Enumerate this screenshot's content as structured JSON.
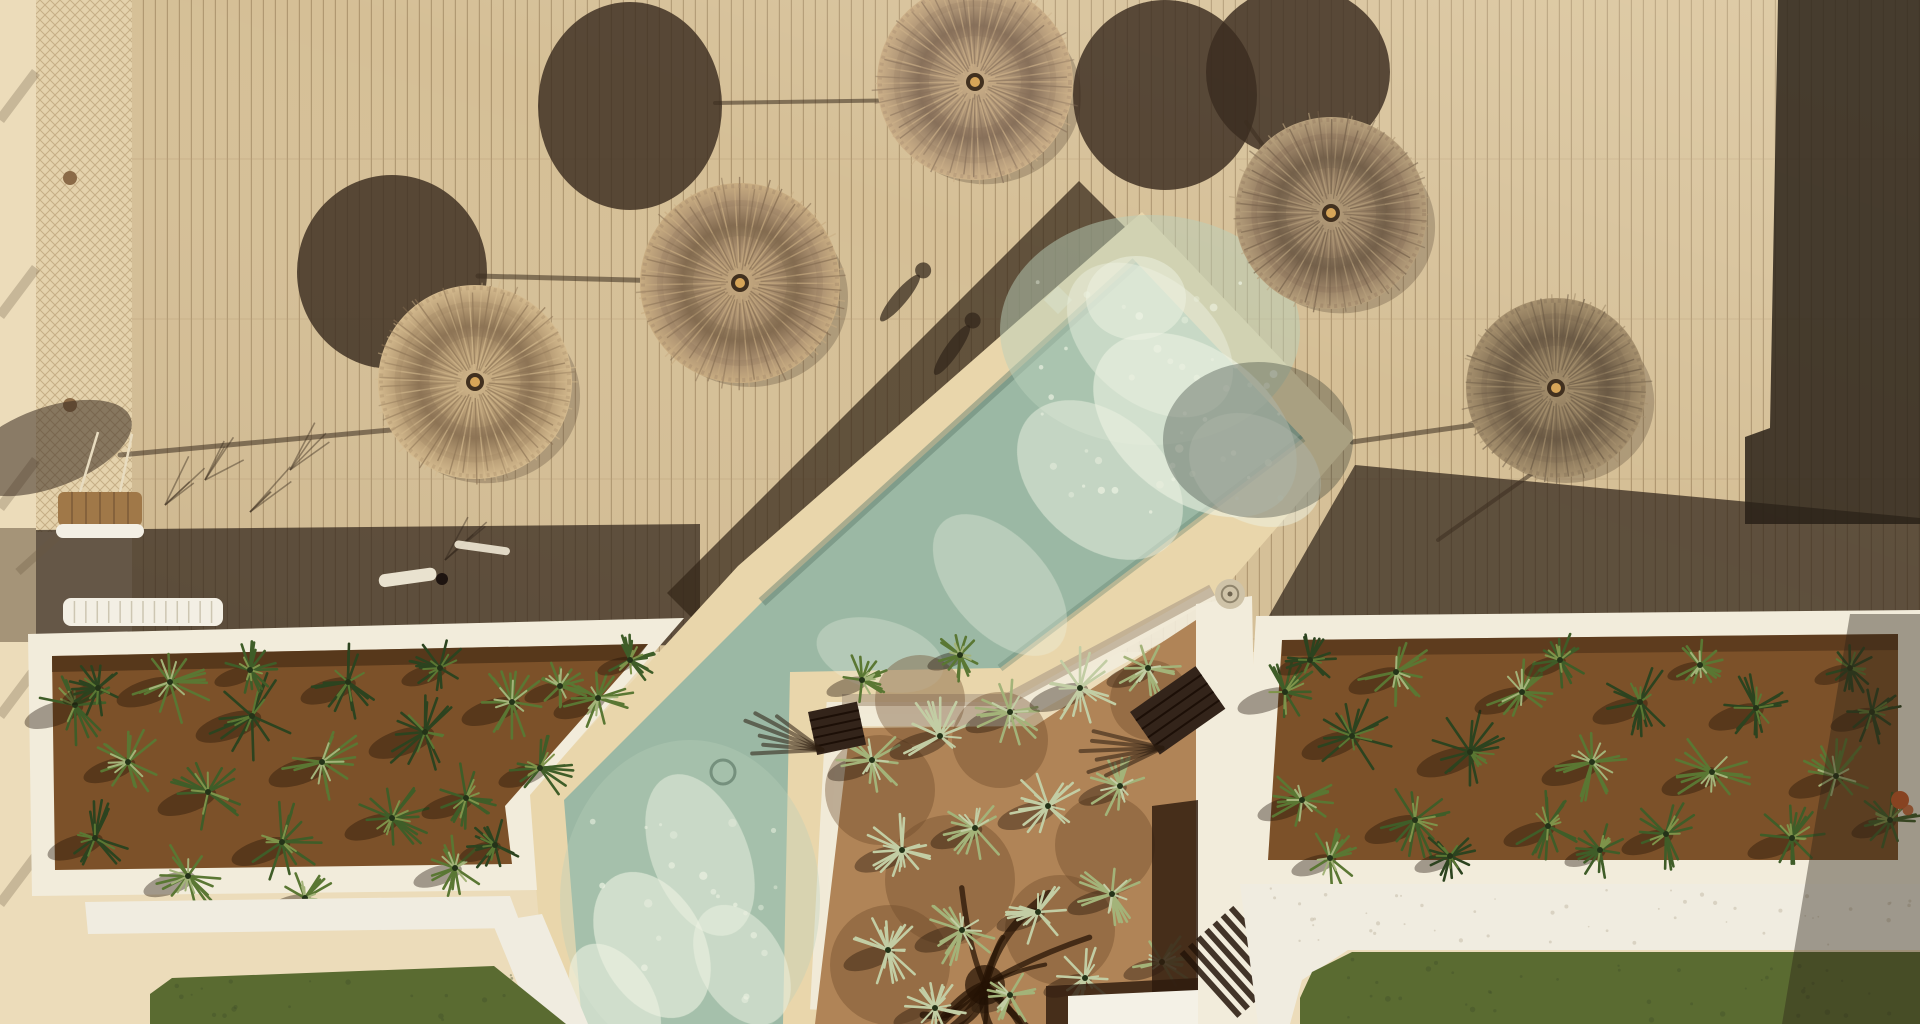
{
  "meta": {
    "description": "Aerial top-down drone photo of a resort pool deck with straw parasols, diagonal swimming pool, agave planters, courtyard garden and lawn",
    "width": 1920,
    "height": 1024
  },
  "palette": {
    "concrete": "#ecdcba",
    "concrete_shadow": "#6b5942",
    "deck": "#d5bf96",
    "plank_line": "#a18760",
    "plank_seam": "#b79d78",
    "band_dark": "#30241a",
    "band_diag": "#352719",
    "dark_right": "#292017",
    "umbrella_shadow": "#3a2c20",
    "border_cream": "#e9d6ab",
    "border_shade": "#b3a28a",
    "wall_white": "#f2ecdb",
    "water": "#9bb8a4",
    "water_light": "#bad0ba",
    "foam": "#eef3e3",
    "water_edge": "#5d7a6b",
    "soil": "#7c5129",
    "soil_dark": "#3f2813",
    "dirt": "#b08457",
    "dirt_shadow": "#6e4a29",
    "greens": [
      "#2c431f",
      "#3f5d28",
      "#5a7733",
      "#7e934a",
      "#a3b379",
      "#c2cda4"
    ],
    "grass": "#5a6b31",
    "grass_dark": "#41512a",
    "path_white": "#f0ece0",
    "wood_dark": "#2e1b0d",
    "slab_white": "#f4f1e6",
    "net": "#ab8f66",
    "bench_wood": "#a07848",
    "frame_white": "#f3efe4",
    "flower_orange": "#c85a28",
    "knot_gold": "#d7a558"
  },
  "deck": {
    "x": 132,
    "y": 0,
    "w": 1788,
    "h": 652,
    "plank_gap": 12,
    "seam_gap": 160
  },
  "fence": {
    "x": 36,
    "w": 98,
    "h": 532,
    "posts": [
      178,
      405
    ],
    "shadow_ys": [
      72,
      268,
      460,
      668,
      856
    ]
  },
  "polygons": {
    "concrete_shadow_left": [
      [
        0,
        528
      ],
      [
        36,
        528
      ],
      [
        36,
        642
      ],
      [
        0,
        642
      ]
    ],
    "band_left": [
      [
        36,
        530
      ],
      [
        700,
        524
      ],
      [
        700,
        645
      ],
      [
        36,
        650
      ]
    ],
    "band_diag": [
      [
        1079,
        181
      ],
      [
        1145,
        247
      ],
      [
        733,
        659
      ],
      [
        667,
        593
      ]
    ],
    "band_right": [
      [
        1355,
        465
      ],
      [
        1920,
        518
      ],
      [
        1920,
        628
      ],
      [
        1262,
        628
      ]
    ],
    "dark_right": [
      [
        1778,
        0
      ],
      [
        1920,
        0
      ],
      [
        1920,
        524
      ],
      [
        1745,
        524
      ],
      [
        1745,
        437
      ],
      [
        1770,
        428
      ]
    ],
    "pool_border": [
      [
        1142,
        212
      ],
      [
        1355,
        437
      ],
      [
        1216,
        598
      ],
      [
        1010,
        714
      ],
      [
        838,
        714
      ],
      [
        820,
        1024
      ],
      [
        548,
        1024
      ],
      [
        528,
        795
      ],
      [
        738,
        566
      ]
    ],
    "pool_water": [
      [
        1136,
        262
      ],
      [
        1303,
        438
      ],
      [
        1000,
        668
      ],
      [
        790,
        672
      ],
      [
        783,
        1024
      ],
      [
        582,
        1024
      ],
      [
        564,
        800
      ],
      [
        762,
        602
      ]
    ],
    "courtyard_wall_right": [
      [
        1196,
        604
      ],
      [
        1252,
        596
      ],
      [
        1260,
        1024
      ],
      [
        1196,
        1024
      ]
    ],
    "courtyard_dirt": [
      [
        850,
        728
      ],
      [
        1035,
        726
      ],
      [
        1196,
        620
      ],
      [
        1196,
        1024
      ],
      [
        815,
        1024
      ]
    ],
    "planter_left_wall": [
      [
        28,
        634
      ],
      [
        684,
        618
      ],
      [
        530,
        795
      ],
      [
        537,
        890
      ],
      [
        32,
        896
      ]
    ],
    "planter_left_soil": [
      [
        52,
        656
      ],
      [
        648,
        644
      ],
      [
        505,
        806
      ],
      [
        512,
        864
      ],
      [
        55,
        870
      ]
    ],
    "planter_left_soil_top": [
      [
        52,
        656
      ],
      [
        648,
        644
      ],
      [
        636,
        660
      ],
      [
        52,
        672
      ]
    ],
    "planter_right_wall": [
      [
        1256,
        616
      ],
      [
        1920,
        610
      ],
      [
        1920,
        884
      ],
      [
        1240,
        884
      ]
    ],
    "planter_right_soil": [
      [
        1282,
        640
      ],
      [
        1898,
        634
      ],
      [
        1898,
        860
      ],
      [
        1268,
        860
      ]
    ],
    "planter_right_soil_top": [
      [
        1282,
        640
      ],
      [
        1898,
        634
      ],
      [
        1898,
        650
      ],
      [
        1282,
        656
      ]
    ],
    "path_left": [
      [
        85,
        902
      ],
      [
        510,
        896
      ],
      [
        522,
        928
      ],
      [
        88,
        934
      ]
    ],
    "path_left_diag": [
      [
        492,
        922
      ],
      [
        542,
        914
      ],
      [
        588,
        1024
      ],
      [
        534,
        1024
      ]
    ],
    "path_right": [
      [
        1240,
        884
      ],
      [
        1920,
        884
      ],
      [
        1920,
        950
      ],
      [
        1348,
        950
      ],
      [
        1302,
        980
      ],
      [
        1290,
        1024
      ],
      [
        1258,
        1024
      ]
    ],
    "grass_left": [
      [
        172,
        978
      ],
      [
        494,
        966
      ],
      [
        566,
        1024
      ],
      [
        150,
        1024
      ],
      [
        150,
        994
      ]
    ],
    "grass_right": [
      [
        1352,
        952
      ],
      [
        1920,
        952
      ],
      [
        1920,
        1024
      ],
      [
        1300,
        1024
      ],
      [
        1300,
        998
      ],
      [
        1312,
        972
      ]
    ],
    "pergola_h": [
      [
        1046,
        986
      ],
      [
        1198,
        978
      ],
      [
        1198,
        1024
      ],
      [
        1046,
        1024
      ]
    ],
    "pergola_v": [
      [
        1152,
        806
      ],
      [
        1198,
        800
      ],
      [
        1198,
        1024
      ],
      [
        1152,
        1024
      ]
    ],
    "slab": [
      [
        1068,
        996
      ],
      [
        1198,
        990
      ],
      [
        1198,
        1024
      ],
      [
        1068,
        1024
      ]
    ],
    "shadow_corner_right": [
      [
        1850,
        614
      ],
      [
        1920,
        614
      ],
      [
        1920,
        1024
      ],
      [
        1782,
        1024
      ]
    ]
  },
  "umbrellas": [
    {
      "cx": 475,
      "cy": 382,
      "r": 97,
      "tone": {
        "l": "#d4ba8e",
        "m": "#b69b74",
        "d": "#8d7455"
      }
    },
    {
      "cx": 740,
      "cy": 283,
      "r": 100,
      "tone": {
        "l": "#c9ad82",
        "m": "#ab9070",
        "d": "#836b50"
      }
    },
    {
      "cx": 975,
      "cy": 82,
      "r": 98,
      "tone": {
        "l": "#cdb189",
        "m": "#b09677",
        "d": "#87705a"
      }
    },
    {
      "cx": 1331,
      "cy": 213,
      "r": 96,
      "tone": {
        "l": "#b7a07c",
        "m": "#9a8266",
        "d": "#74604a"
      }
    },
    {
      "cx": 1556,
      "cy": 388,
      "r": 90,
      "tone": {
        "l": "#a8926f",
        "m": "#8d795c",
        "d": "#6b5a45"
      }
    }
  ],
  "umbrella_shadows": [
    {
      "cx": 48,
      "cy": 448,
      "rx": 88,
      "ry": 40,
      "rot": -20,
      "op": 0.55
    },
    {
      "cx": 392,
      "cy": 272,
      "rx": 95,
      "ry": 97,
      "rot": 0,
      "op": 0.82
    },
    {
      "cx": 630,
      "cy": 106,
      "rx": 92,
      "ry": 104,
      "rot": 0,
      "op": 0.82
    },
    {
      "cx": 1165,
      "cy": 95,
      "rx": 92,
      "ry": 95,
      "rot": 0,
      "op": 0.82
    },
    {
      "cx": 1298,
      "cy": 72,
      "rx": 92,
      "ry": 86,
      "rot": 0,
      "op": 0.82
    }
  ],
  "pool_shadow": {
    "cx": 1258,
    "cy": 440,
    "rx": 95,
    "ry": 78,
    "op": 0.32
  },
  "pole_shadows": [
    [
      412,
      428,
      120,
      455,
      5
    ],
    [
      668,
      281,
      478,
      276,
      5
    ],
    [
      912,
      100,
      715,
      103,
      4
    ],
    [
      1300,
      196,
      1246,
      122,
      4
    ],
    [
      1510,
      420,
      1352,
      442,
      5
    ],
    [
      1540,
      468,
      1438,
      540,
      4
    ]
  ],
  "figure_shadows": [
    [
      900,
      298,
      40
    ],
    [
      952,
      350,
      35
    ]
  ],
  "foam": [
    [
      1150,
      340,
      95,
      62,
      40,
      0.45
    ],
    [
      1195,
      425,
      115,
      75,
      38,
      0.6
    ],
    [
      1100,
      480,
      95,
      65,
      42,
      0.5
    ],
    [
      1255,
      470,
      70,
      52,
      30,
      0.5
    ],
    [
      1000,
      585,
      85,
      48,
      48,
      0.35
    ],
    [
      880,
      655,
      65,
      35,
      15,
      0.3
    ],
    [
      700,
      855,
      85,
      48,
      68,
      0.5
    ],
    [
      652,
      945,
      78,
      52,
      62,
      0.6
    ],
    [
      742,
      965,
      65,
      42,
      60,
      0.5
    ],
    [
      615,
      1000,
      62,
      38,
      58,
      0.6
    ],
    [
      1136,
      298,
      50,
      42,
      0,
      0.5
    ]
  ],
  "caustic_regions": [
    {
      "x0": 1030,
      "y0": 278,
      "x1": 1295,
      "y1": 520,
      "n": 46
    },
    {
      "x0": 592,
      "y0": 820,
      "x1": 778,
      "y1": 1012,
      "n": 22
    }
  ],
  "water_highlights": [
    {
      "cx": 1150,
      "cy": 330,
      "rx": 150,
      "ry": 115,
      "op": 0.5
    },
    {
      "cx": 690,
      "cy": 900,
      "rx": 130,
      "ry": 160,
      "op": 0.35
    }
  ],
  "plants_left": [
    [
      75,
      705,
      34,
      1
    ],
    [
      128,
      762,
      30,
      2
    ],
    [
      95,
      838,
      32,
      0
    ],
    [
      170,
      682,
      36,
      2
    ],
    [
      208,
      792,
      34,
      1
    ],
    [
      252,
      716,
      38,
      0
    ],
    [
      188,
      876,
      30,
      2
    ],
    [
      282,
      842,
      34,
      1
    ],
    [
      322,
      762,
      36,
      2
    ],
    [
      348,
      682,
      32,
      0
    ],
    [
      305,
      898,
      26,
      2
    ],
    [
      392,
      818,
      32,
      1
    ],
    [
      425,
      732,
      38,
      0
    ],
    [
      455,
      868,
      28,
      2
    ],
    [
      466,
      798,
      30,
      1
    ],
    [
      512,
      702,
      34,
      2
    ],
    [
      540,
      768,
      28,
      1
    ],
    [
      495,
      845,
      24,
      0
    ],
    [
      598,
      698,
      30,
      2
    ],
    [
      98,
      688,
      24,
      0
    ],
    [
      250,
      670,
      24,
      1
    ],
    [
      440,
      668,
      26,
      0
    ],
    [
      560,
      686,
      24,
      2
    ],
    [
      630,
      660,
      22,
      1
    ]
  ],
  "plants_right": [
    [
      1285,
      692,
      32,
      1
    ],
    [
      1302,
      800,
      30,
      2
    ],
    [
      1352,
      736,
      34,
      0
    ],
    [
      1396,
      672,
      32,
      2
    ],
    [
      1415,
      820,
      34,
      1
    ],
    [
      1470,
      752,
      36,
      0
    ],
    [
      1522,
      692,
      32,
      2
    ],
    [
      1548,
      826,
      30,
      1
    ],
    [
      1592,
      762,
      34,
      2
    ],
    [
      1640,
      702,
      32,
      0
    ],
    [
      1666,
      834,
      30,
      1
    ],
    [
      1712,
      772,
      34,
      2
    ],
    [
      1756,
      708,
      32,
      0
    ],
    [
      1792,
      838,
      30,
      1
    ],
    [
      1836,
      776,
      32,
      2
    ],
    [
      1872,
      712,
      28,
      0
    ],
    [
      1890,
      820,
      26,
      1
    ],
    [
      1330,
      858,
      26,
      2
    ],
    [
      1450,
      856,
      24,
      0
    ],
    [
      1600,
      850,
      24,
      1
    ],
    [
      1310,
      660,
      22,
      0
    ],
    [
      1560,
      660,
      24,
      1
    ],
    [
      1700,
      665,
      22,
      2
    ],
    [
      1850,
      668,
      24,
      0
    ]
  ],
  "plants_courtyard": [
    [
      872,
      760,
      30,
      4
    ],
    [
      940,
      736,
      34,
      5
    ],
    [
      1010,
      712,
      30,
      4
    ],
    [
      1080,
      688,
      34,
      5
    ],
    [
      1148,
      668,
      28,
      4
    ],
    [
      902,
      850,
      32,
      5
    ],
    [
      975,
      828,
      30,
      4
    ],
    [
      1048,
      806,
      34,
      5
    ],
    [
      1120,
      786,
      28,
      4
    ],
    [
      888,
      950,
      30,
      5
    ],
    [
      962,
      930,
      32,
      4
    ],
    [
      1038,
      912,
      28,
      5
    ],
    [
      1112,
      894,
      30,
      4
    ],
    [
      935,
      1008,
      28,
      5
    ],
    [
      1010,
      995,
      26,
      4
    ],
    [
      1085,
      978,
      28,
      5
    ],
    [
      1162,
      962,
      26,
      4
    ],
    [
      862,
      680,
      24,
      2
    ],
    [
      960,
      655,
      22,
      2
    ]
  ],
  "dirt_blobs": [
    [
      880,
      790,
      55
    ],
    [
      1000,
      740,
      48
    ],
    [
      950,
      880,
      65
    ],
    [
      1105,
      845,
      50
    ],
    [
      890,
      965,
      60
    ],
    [
      1060,
      930,
      55
    ],
    [
      1150,
      700,
      40
    ],
    [
      920,
      700,
      45
    ]
  ],
  "tree_shadow": {
    "cx": 985,
    "cy": 985,
    "strokes": 14
  },
  "loungers": [
    {
      "x": 808,
      "y": 712,
      "w": 50,
      "h": 44,
      "rot": -12
    },
    {
      "x": 1130,
      "y": 712,
      "w": 80,
      "h": 52,
      "rot": -35
    }
  ],
  "br_slats": {
    "x": 1182,
    "y": 952,
    "n": 7,
    "len": 86,
    "rot": -42,
    "gap": 11
  },
  "bench": {
    "x": 58,
    "y": 492,
    "w": 84,
    "h": 34
  },
  "sunbed": {
    "x": 63,
    "y": 598,
    "w": 160,
    "h": 28
  },
  "white_paddle": [
    378,
    575,
    58,
    13,
    -8
  ],
  "deck_knife": [
    455,
    540,
    56,
    8,
    8
  ],
  "grass_tufts": [
    [
      165,
      505
    ],
    [
      205,
      480
    ],
    [
      250,
      512
    ],
    [
      290,
      470
    ],
    [
      445,
      560
    ]
  ],
  "details": {
    "skimmer_right": {
      "cx": 1230,
      "cy": 594,
      "r": 15
    },
    "skimmer_left": {
      "cx": 1058,
      "cy": 300,
      "s": 20
    },
    "drain": {
      "cx": 723,
      "cy": 772,
      "r": 12
    },
    "flower": {
      "cx": 1900,
      "cy": 800,
      "r": 9
    }
  }
}
